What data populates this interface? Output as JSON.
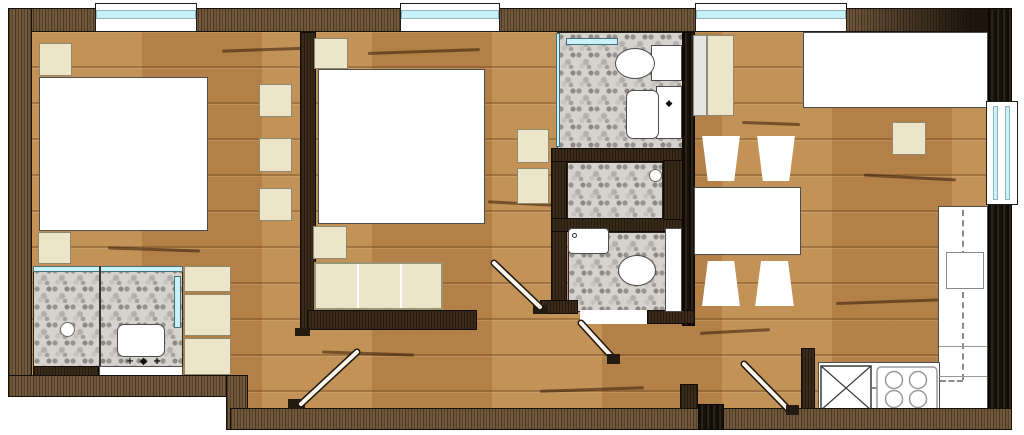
{
  "title": "apartment-floor-plan",
  "colors": {
    "wall_outer": "#5d4936",
    "wall_dark": "#221a12",
    "wall_inner": "#3a2a18",
    "floor_wood": "#bc8a50",
    "tile": "#d6d3cf",
    "furniture_beige": "#ece5c9",
    "furniture_white": "#ffffff",
    "glass": "#c9f1fa",
    "door_leaf": "#fdf6ea",
    "outline": "#160f08"
  },
  "glyphs": {
    "faucet_row": "+ ◆ +",
    "plus": "+",
    "diamond": "◆"
  },
  "rooms": [
    {
      "id": "bedroom-1"
    },
    {
      "id": "ensuite-shower-room"
    },
    {
      "id": "bedroom-2"
    },
    {
      "id": "bathroom-top"
    },
    {
      "id": "shower-cell"
    },
    {
      "id": "bathroom-bottom"
    },
    {
      "id": "hallway"
    },
    {
      "id": "living-dining-kitchen"
    }
  ],
  "fixtures": [
    "bed",
    "wardrobe",
    "nightstand",
    "shower-drain",
    "washbasin",
    "toilet",
    "bathtub",
    "dining-table",
    "chair",
    "sofa",
    "kitchen-counter",
    "cooktop",
    "sink-unit",
    "window",
    "door"
  ]
}
